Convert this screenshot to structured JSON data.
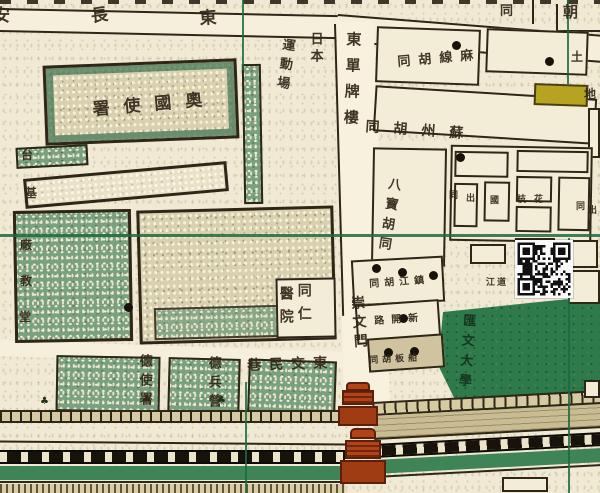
{
  "map": {
    "title_labels_note": "historical city map, text reads right-to-left / vertical",
    "colors": {
      "paper": "#f0e9d4",
      "outline": "#2e2616",
      "green_field": "#2f7a4b",
      "grid_green": "#1b6a41",
      "yellow_lot": "#b5a321",
      "gate_red": "#b04418",
      "rail_black": "#17120a",
      "label_ink": "#33281a"
    },
    "labels": [
      {
        "n": "changan-char-an",
        "t": "安",
        "x": -7,
        "y": 8,
        "fs": 17
      },
      {
        "n": "changan-char-chang",
        "t": "長",
        "x": 90,
        "y": 9,
        "fs": 17,
        "rot": -8
      },
      {
        "n": "changan-char-dong",
        "t": "東",
        "x": 199,
        "y": 11,
        "fs": 17,
        "rot": -4
      },
      {
        "n": "topright-char-tong",
        "t": "同",
        "x": 500,
        "y": 5,
        "fs": 13
      },
      {
        "n": "topright-char-chao",
        "t": "朝",
        "x": 563,
        "y": 5,
        "fs": 15
      },
      {
        "n": "nihon",
        "t": "日本",
        "x": 308,
        "y": 32,
        "fs": 13,
        "dir": "v",
        "ls": 4
      },
      {
        "n": "undojo",
        "t": "運動場",
        "x": 281,
        "y": 37,
        "fs": 13,
        "dir": "v",
        "ls": 6,
        "rot": 8
      },
      {
        "n": "dongdan-pailou",
        "t": "東單牌樓",
        "x": 345,
        "y": 31,
        "fs": 15,
        "dir": "v",
        "ls": 11,
        "rot": 2
      },
      {
        "n": "maxian-hutong",
        "t": "麻線胡同",
        "x": 397,
        "y": 56,
        "fs": 13,
        "dir": "rtl",
        "ls": 8,
        "rot": -5
      },
      {
        "n": "tudi-char-tu",
        "t": "土",
        "x": 571,
        "y": 51,
        "fs": 12
      },
      {
        "n": "tudi-char-di",
        "t": "地",
        "x": 584,
        "y": 88,
        "fs": 12
      },
      {
        "n": "suzhou-hutong",
        "t": "蘇州胡同",
        "x": 366,
        "y": 120,
        "fs": 14,
        "dir": "rtl",
        "ls": 14,
        "rot": 4
      },
      {
        "n": "babao-hutong",
        "t": "八寶胡同",
        "x": 387,
        "y": 176,
        "fs": 13,
        "dir": "v",
        "ls": 7,
        "rot": 9
      },
      {
        "n": "lot-char-1",
        "t": "同",
        "x": 449,
        "y": 192,
        "fs": 9
      },
      {
        "n": "lot-char-2",
        "t": "出",
        "x": 466,
        "y": 195,
        "fs": 9
      },
      {
        "n": "lot-char-3",
        "t": "國",
        "x": 490,
        "y": 197,
        "fs": 9
      },
      {
        "n": "lot-char-4",
        "t": "枝",
        "x": 517,
        "y": 196,
        "fs": 9
      },
      {
        "n": "lot-char-5",
        "t": "花",
        "x": 534,
        "y": 196,
        "fs": 9
      },
      {
        "n": "lot-char-6",
        "t": "同",
        "x": 576,
        "y": 203,
        "fs": 9
      },
      {
        "n": "lot-char-7",
        "t": "出",
        "x": 588,
        "y": 207,
        "fs": 9
      },
      {
        "n": "huiwen-university",
        "t": "匯文大學",
        "x": 461,
        "y": 313,
        "fs": 13,
        "dir": "v",
        "ls": 7,
        "rot": 4,
        "c": "#14321d"
      },
      {
        "n": "zhenjiang-hutong",
        "t": "鎮江胡同",
        "x": 369,
        "y": 280,
        "fs": 10,
        "dir": "rtl",
        "ls": 5,
        "rot": -4
      },
      {
        "n": "xinkailu",
        "t": "新開路",
        "x": 374,
        "y": 317,
        "fs": 10,
        "dir": "rtl",
        "ls": 7,
        "rot": -4
      },
      {
        "n": "chuanban-hutong",
        "t": "船板胡同",
        "x": 369,
        "y": 357,
        "fs": 9,
        "dir": "rtl",
        "ls": 4,
        "rot": -3
      },
      {
        "n": "jiang-dao",
        "t": "江道",
        "x": 486,
        "y": 279,
        "fs": 9,
        "ls": 2
      },
      {
        "n": "tongren-col",
        "t": "同仁",
        "x": 296,
        "y": 283,
        "fs": 14,
        "dir": "v",
        "ls": 9
      },
      {
        "n": "yiyuan-col",
        "t": "醫院",
        "x": 278,
        "y": 286,
        "fs": 14,
        "dir": "v",
        "ls": 9
      },
      {
        "n": "chongwenmen",
        "t": "崇文門",
        "x": 349,
        "y": 296,
        "fs": 14,
        "dir": "v",
        "ls": 5,
        "rot": -4
      },
      {
        "n": "dongjiaominxiang",
        "t": "東交民巷",
        "x": 247,
        "y": 359,
        "fs": 14,
        "dir": "rtl",
        "ls": 8,
        "rot": -2
      },
      {
        "n": "german-legation",
        "t": "德使署",
        "x": 137,
        "y": 354,
        "fs": 13,
        "dir": "v",
        "ls": 6
      },
      {
        "n": "german-barracks",
        "t": "德兵營",
        "x": 206,
        "y": 356,
        "fs": 13,
        "dir": "v",
        "ls": 6
      },
      {
        "n": "austrian-legation",
        "t": "奧國使署",
        "x": 92,
        "y": 102,
        "fs": 17,
        "dir": "rtl",
        "ls": 14,
        "rot": -5
      },
      {
        "n": "taijichang-tai",
        "t": "台",
        "x": 21,
        "y": 149,
        "fs": 12
      },
      {
        "n": "taijichang-ji",
        "t": "基",
        "x": 25,
        "y": 187,
        "fs": 12
      },
      {
        "n": "taijichang-chang",
        "t": "廠",
        "x": 20,
        "y": 239,
        "fs": 12
      },
      {
        "n": "jiaotang-jiao",
        "t": "教",
        "x": 20,
        "y": 275,
        "fs": 12
      },
      {
        "n": "jiaotang-tang",
        "t": "堂",
        "x": 19,
        "y": 311,
        "fs": 12
      }
    ],
    "dots": [
      [
        452,
        41
      ],
      [
        545,
        57
      ],
      [
        456,
        153
      ],
      [
        372,
        264
      ],
      [
        398,
        268
      ],
      [
        429,
        271
      ],
      [
        399,
        314
      ],
      [
        124,
        303
      ],
      [
        384,
        348
      ],
      [
        410,
        347
      ]
    ],
    "trees": [
      [
        40,
        396
      ],
      [
        142,
        394
      ],
      [
        217,
        395
      ]
    ],
    "qr": {
      "x": 515,
      "y": 240,
      "size": 58
    }
  }
}
